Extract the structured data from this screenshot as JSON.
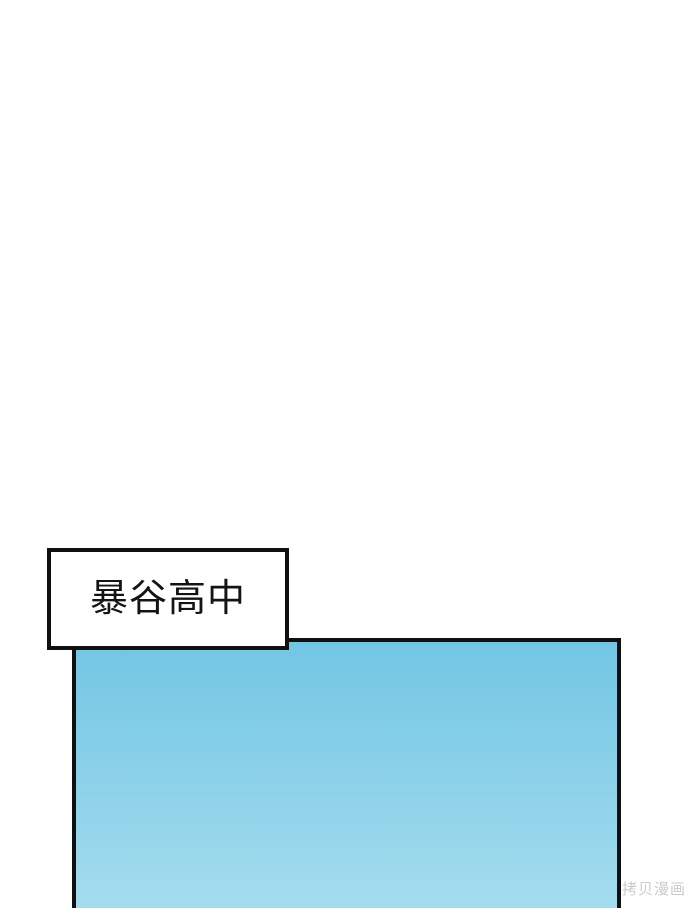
{
  "page": {
    "background": "#ffffff"
  },
  "label_box": {
    "text": "暴谷高中"
  },
  "panel": {
    "type": "comic-sky-panel",
    "color_top": "#72c6e4",
    "color_bottom": "#a4dcee",
    "border_color": "#101010"
  },
  "watermark": {
    "text": "拷贝漫画",
    "color": "#cbcbcb"
  }
}
